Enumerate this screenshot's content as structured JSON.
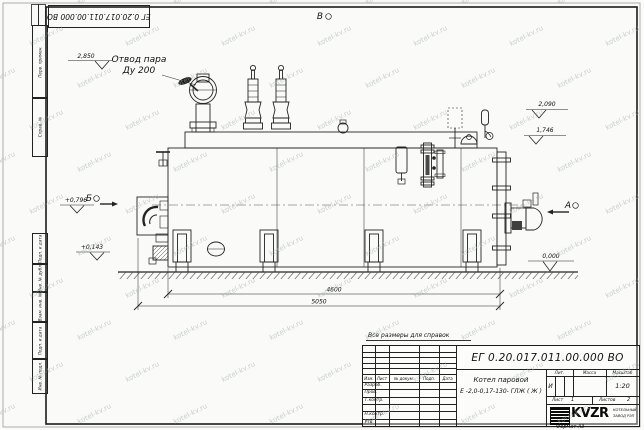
{
  "watermark": {
    "text": "kotel-kv.ru"
  },
  "sheet": {
    "top_designation": "ЕГ 0.20.017.011.00.000  ВО",
    "left_stamps": [
      "Перв. примен.",
      "Справ. №",
      "Подп. и дата",
      "Инв. № дубл.",
      "Взам. инв. №",
      "Подп. и дата",
      "Инв. № подл."
    ],
    "note": "Все размеры для справок",
    "format": "Формат А3"
  },
  "drawing": {
    "steam_outlet": {
      "line1": "Отвод пара",
      "line2": "Ду 200"
    },
    "views": {
      "a": "А",
      "b": "Б",
      "v": "В"
    },
    "elevations": {
      "top": "2,850",
      "upper_right": "2,090",
      "mid_right": "1,746",
      "front_upper": "+0,796",
      "front_lower": "+0,143",
      "ground": "0,000"
    },
    "dimensions": {
      "inner": "4600",
      "overall": "5050"
    }
  },
  "title_block": {
    "designation": "ЕГ 0.20.017.011.00.000  ВО",
    "name_line1": "Котел паровой",
    "name_line2": "Е -2,0-0,17-130- ГЛЖ ( Ж )",
    "cols": {
      "izm": "Изм.",
      "list": "Лист",
      "doc": "№ докум.",
      "podp": "Подп.",
      "date": "Дата"
    },
    "rows": [
      "Разраб.",
      "Пров.",
      "Т.контр.",
      "",
      "Н.контр.",
      "Утв."
    ],
    "lit_label": "Лит.",
    "lit_value": "И",
    "mass_label": "Масса",
    "scale_label": "Масштаб",
    "scale_value": "1:20",
    "sheet_label": "Лист",
    "sheet_value": "1",
    "sheets_label": "Листов",
    "sheets_value": "2",
    "logo_text": "KVZR",
    "company_line1": "КОТЕЛЬНЫЙ",
    "company_line2": "ЗАВОД РЭП"
  }
}
